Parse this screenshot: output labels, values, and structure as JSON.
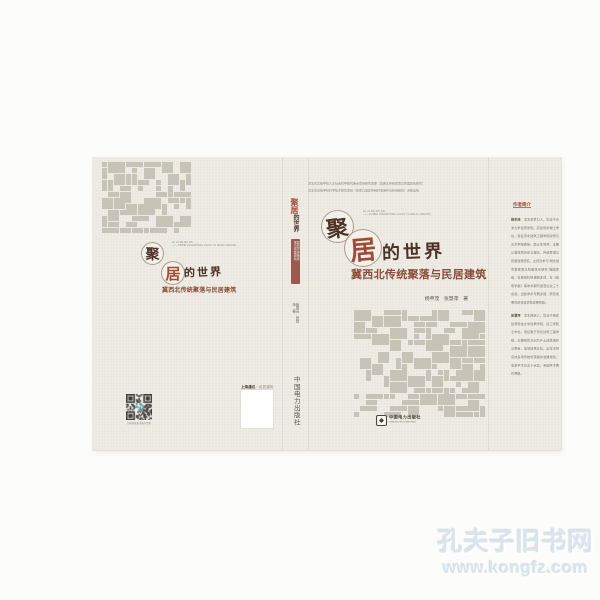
{
  "watermark": {
    "site_name": "孔夫子旧书网",
    "site_url": "www.kongfz.com"
  },
  "cover": {
    "title_char_1": "聚",
    "title_char_2": "居",
    "title_rest": "的世界",
    "subtitle": "冀西北传统聚落与民居建筑",
    "authors": "杨申茂　张慧萍　著",
    "publisher_cn": "中国电力出版社",
    "publisher_en": "CHINA ELECTRIC POWER PRESS",
    "front": {
      "note_line_1": "河北省高等学校人文社会科学研究重点项目研究成果（冀西北传统聚落与民居建筑研究）",
      "note_line_2": "河北省高等学校科学技术研究项目（张家口地区传统村落保护与利用研究）资助出版",
      "tagline_line_1": "JU JU DE SHI JIE",
      "tagline_line_2": "—— JIXIBEI CHUANTONG JULUO YU MINJU JIANZHU"
    },
    "back": {
      "tagline_line_1": "JU JU DE SHI JIE",
      "tagline_line_2": "—— JIXIBEI CHUANTONG JULUO YU MINJU JIANZHU",
      "qr_caption": "扫码获取更多图书资讯",
      "shelf_label": "上架建议",
      "shelf_value": "：民居建筑"
    },
    "flap": {
      "heading": "作者简介",
      "bio_1_name": "杨申茂",
      "bio_1_text": "　河北张家口人，毕业于天津大学建筑学院，获建筑学博士学位。现任河北建筑工程学院建筑与艺术学院教授、硕士生导师，主要从事建筑历史与理论、传统聚落与民居建筑研究。主持及参与“明长城军事聚落与防御体系研究”等国家级、省部级科研课题多项，在《建筑学报》等学术期刊发表论文三十余篇，出版学术专著多部，研究成果曾获省级优秀成果奖励。",
      "bio_2_name": "张慧萍",
      "bio_2_text": "　河北保定人，毕业于西安建筑科技大学建筑学院，获工学硕士学位。现任教于河北建筑工程学院，主要研究方向为乡土建筑保护与更新、地域建筑文化。近年主持完成多项传统村落保护发展规划，发表学术论文十余篇，参编学术著作两部。"
    }
  },
  "colors": {
    "cover_bg": "#ebe8df",
    "pattern_gray": "#c8c3b7",
    "title_dark": "#4c3328",
    "title_red": "#a24a38",
    "subtitle_red": "#8a4c38",
    "spine_band": "#9a5a50",
    "micro_text": "#8f8a7c",
    "flap_text": "#7b7668",
    "flap_heading": "#9c4f38",
    "watermark_blue": "#d9e4ee"
  }
}
